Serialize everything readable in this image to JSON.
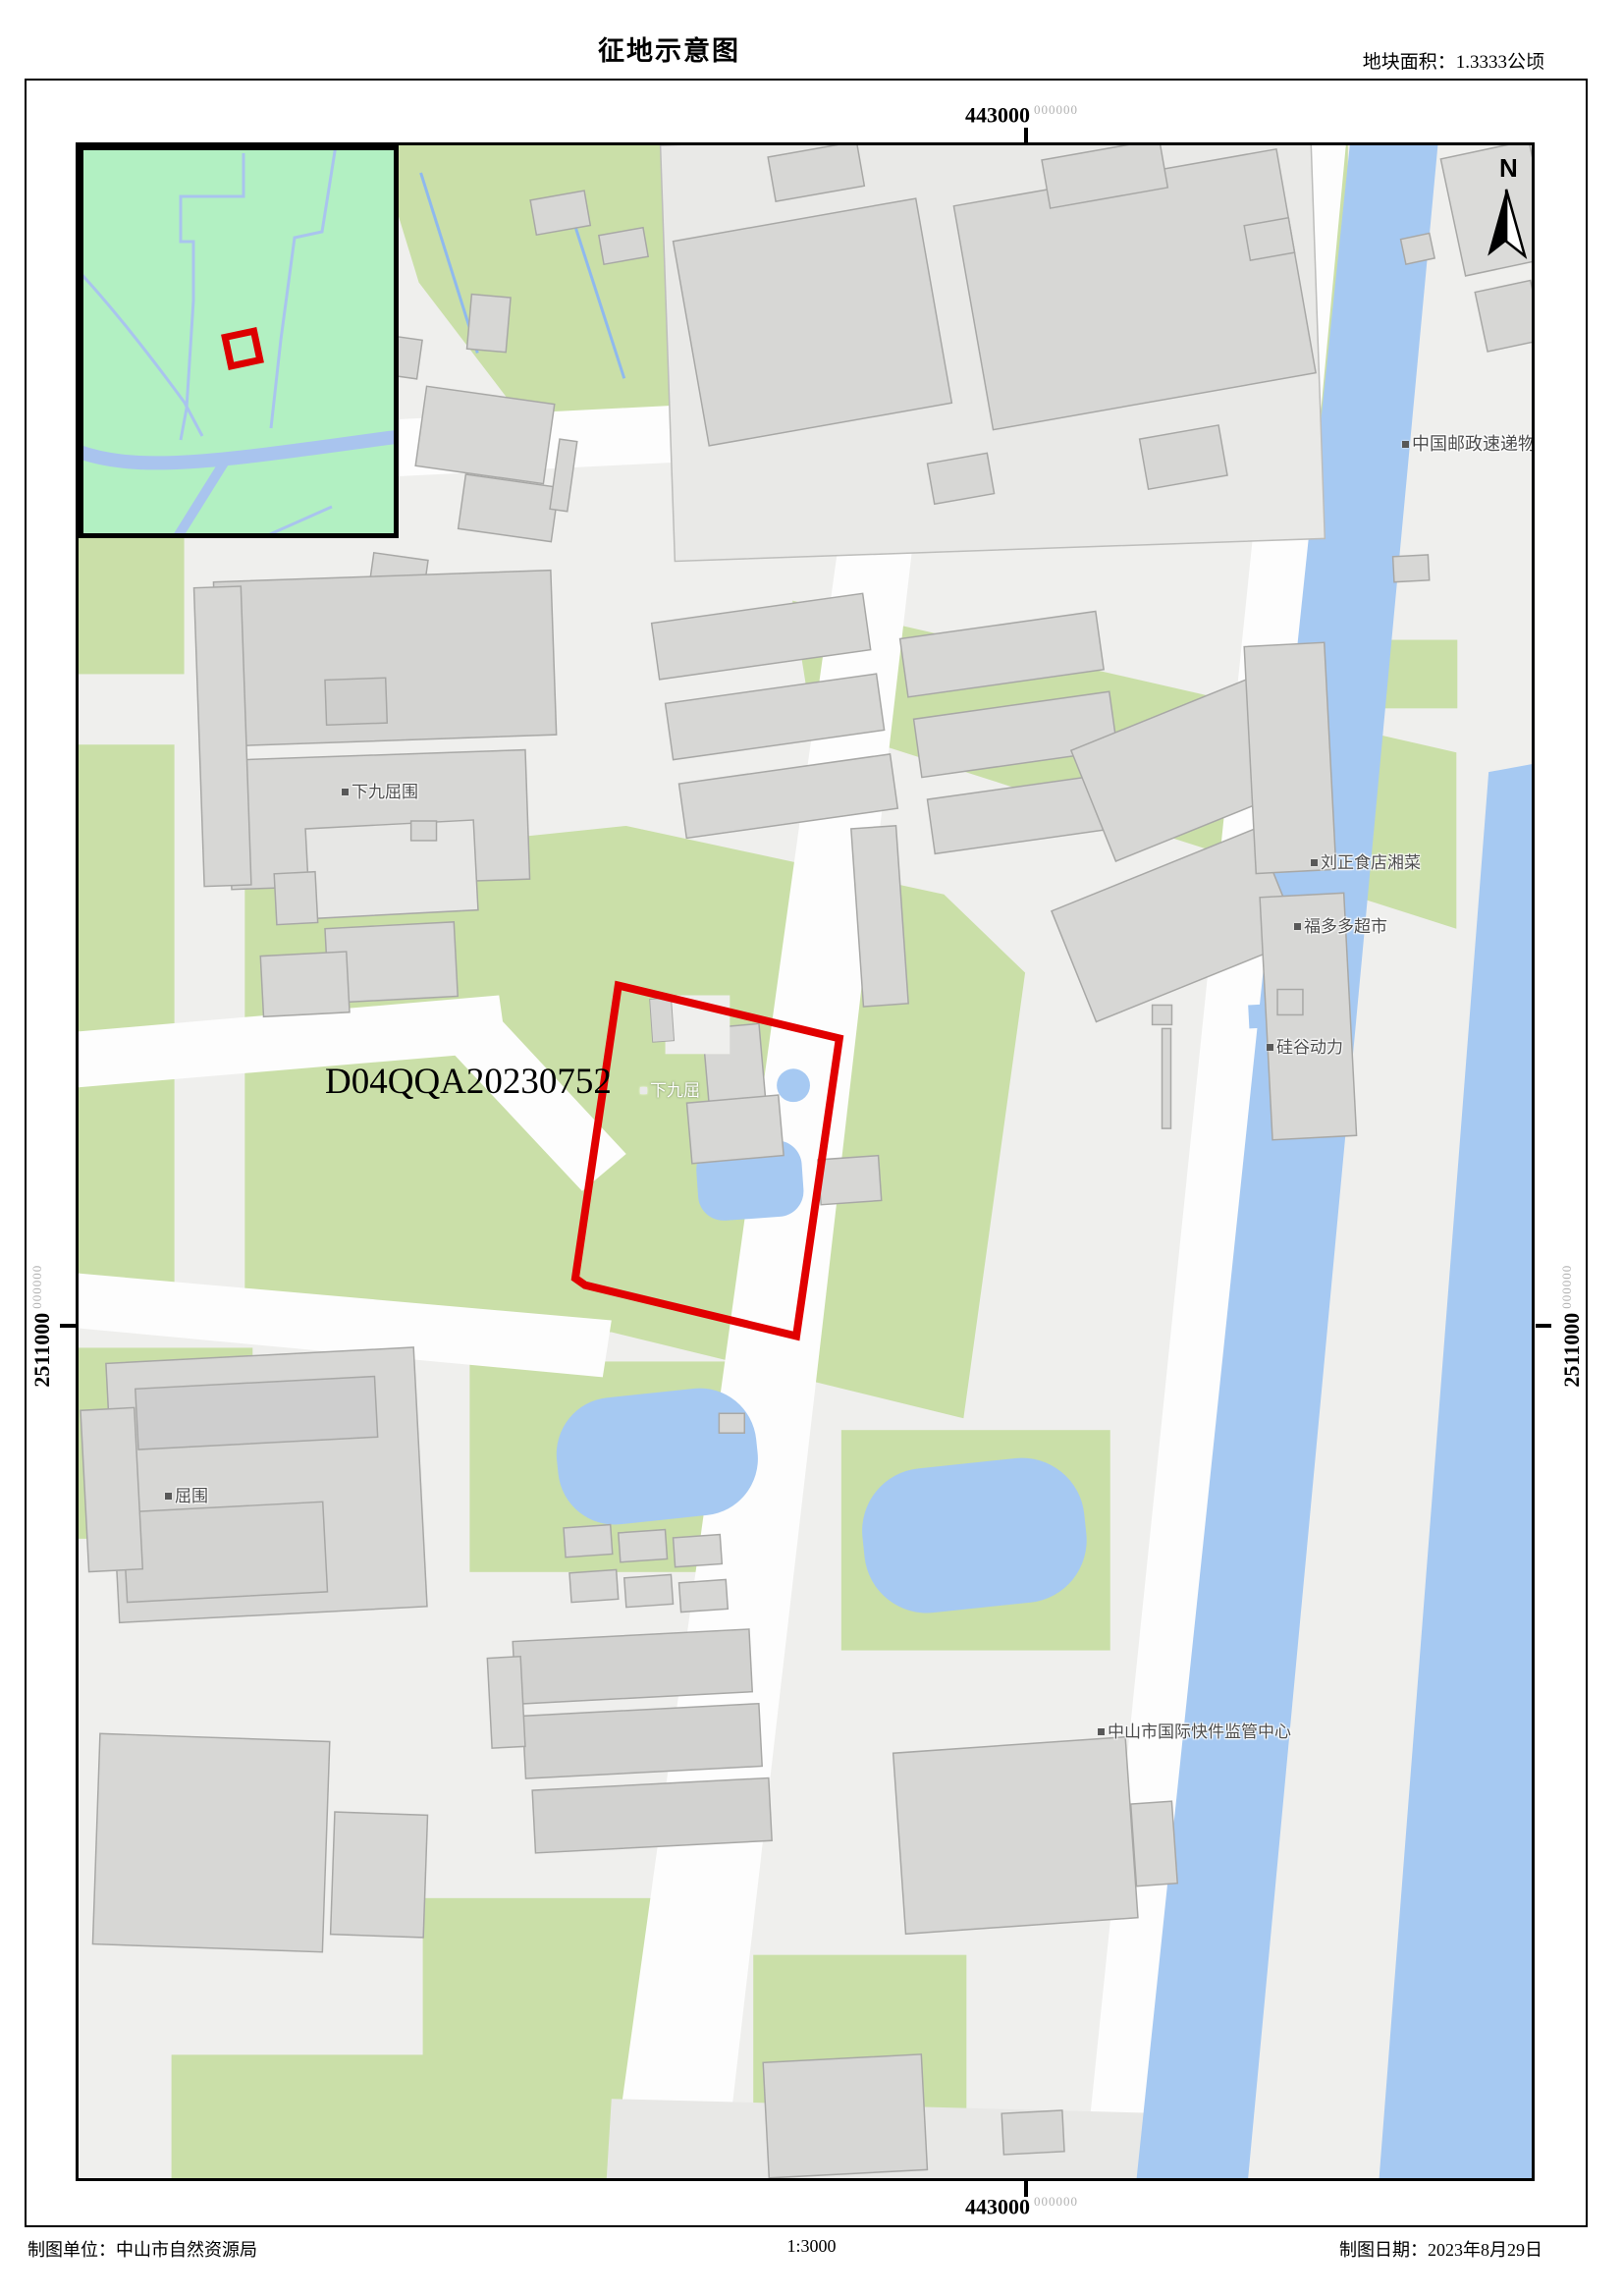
{
  "header": {
    "title": "征地示意图",
    "area_label": "地块面积：1.3333公顷"
  },
  "footer": {
    "agency": "制图单位：中山市自然资源局",
    "scale": "1:3000",
    "date": "制图日期：2023年8月29日"
  },
  "coordinates": {
    "top": {
      "main": "443000",
      "sup": "000000"
    },
    "bottom": {
      "main": "443000",
      "sup": "000000"
    },
    "left": {
      "main": "2511000",
      "sup": "000000"
    },
    "right": {
      "main": "2511000",
      "sup": "000000"
    }
  },
  "north_label": "N",
  "parcel": {
    "code": "D04QQA20230752",
    "name_label": "下九屈"
  },
  "map_labels": [
    {
      "id": "xiajiuquwei",
      "text": "下九屈围"
    },
    {
      "id": "liuzheng-restaurant",
      "text": "刘正食店湘菜"
    },
    {
      "id": "fuduoduo-market",
      "text": "福多多超市"
    },
    {
      "id": "guigu-power",
      "text": "硅谷动力"
    },
    {
      "id": "china-post",
      "text": "中国邮政速递物"
    },
    {
      "id": "quwei",
      "text": "屈围"
    },
    {
      "id": "express-center",
      "text": "中山市国际快件监管中心"
    }
  ],
  "colors": {
    "parcel_outline": "#e10000",
    "inset_highlight": "#dd0000",
    "green_area": "#cadfa8",
    "inset_green": "#b2f0c2",
    "water": "#a6c9f2",
    "inset_water": "#a9c4ee",
    "building_fill": "#d7d7d5",
    "building_stroke": "#a8a8a6",
    "road_open": "#efefed",
    "coord_sup_gray": "#b2b2b2",
    "label_text": "#4c4c4c"
  }
}
